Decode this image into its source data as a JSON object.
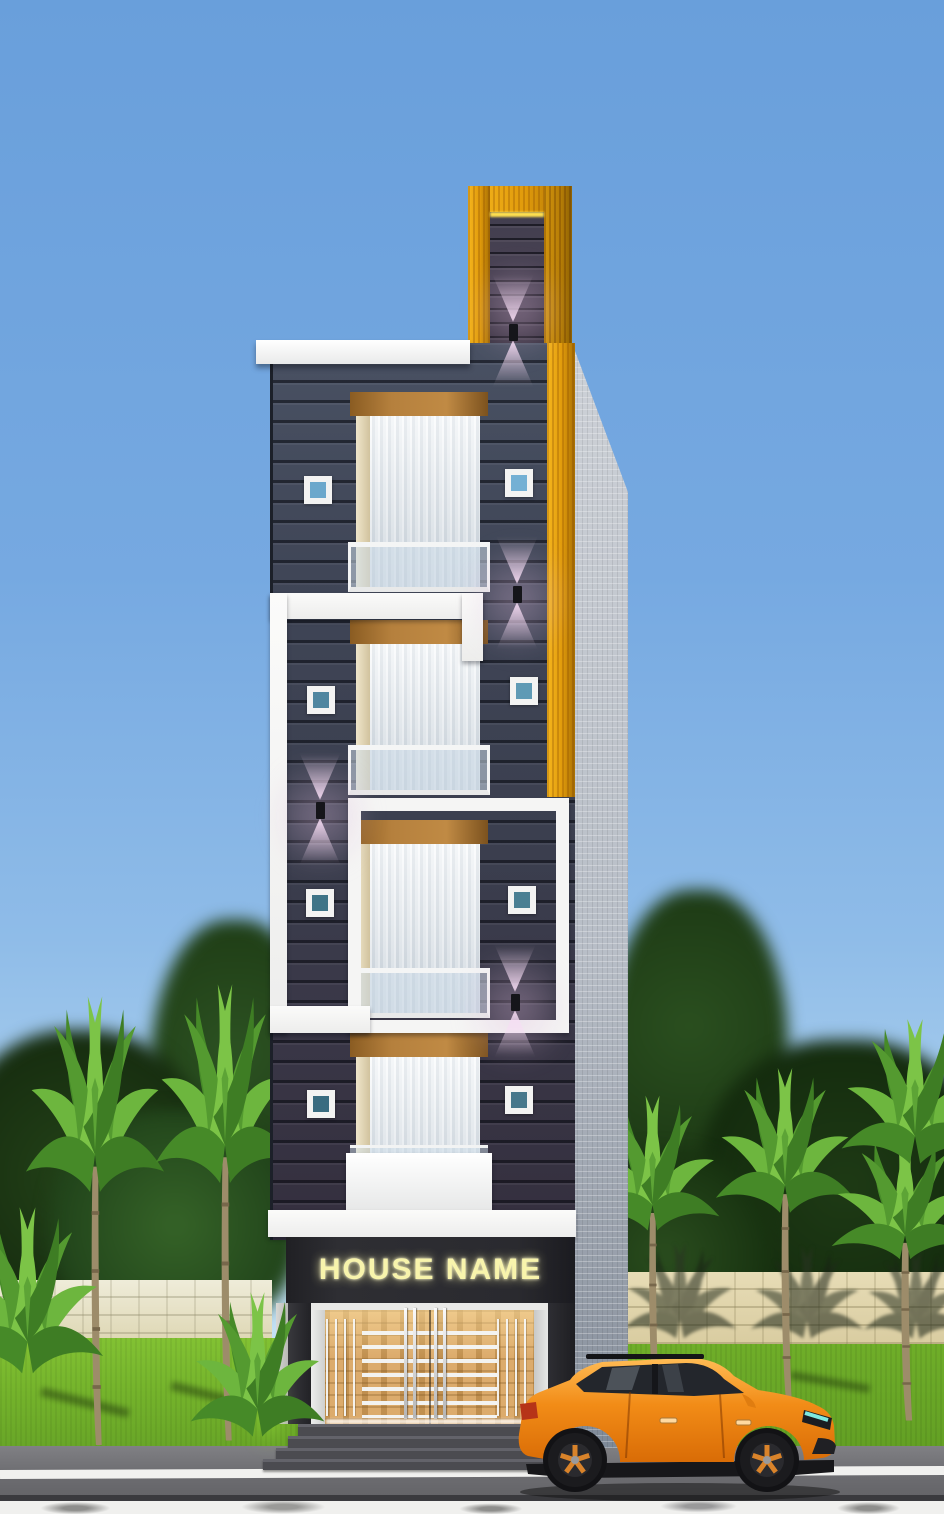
{
  "scene": {
    "kind": "3D architectural render, dusk lighting",
    "subject": "narrow four-storey modern house front elevation with shop-style entrance",
    "sign": {
      "text": "HOUSE NAME"
    },
    "counts": {
      "floors": 4,
      "balcony_windows": 4,
      "small_square_windows": 8,
      "wall_lights": 4,
      "tower_lights": 1,
      "entrance_steps": 4,
      "palm_trees": 7
    },
    "palette": {
      "sky_top": "#699fdb",
      "sky_horizon": "#d3ecf8",
      "facade_dark": "#3c4252",
      "facade_groove": "#12141d",
      "gold_accent": "#e8a414",
      "gold_glow_line": "#ffe14f",
      "white_trim": "#f4f4f3",
      "side_wall_gray": "#b8bec7",
      "window_wood": "#b5803d",
      "curtain_white": "#e8edf1",
      "balcony_glass": "#cedde9",
      "square_window_glass": "#4f86a0",
      "wall_light_glow": "#f7ddf5",
      "sign_panel": "#26262b",
      "sign_letters": "#f8f4ac",
      "entrance_wood": "#c99a5a",
      "entrance_bars": "#f3f3f1",
      "steps_gray": "#4b4b50",
      "lawn_green": "#74b32b",
      "road_gray": "#6d6d71",
      "road_line_white": "#f1f1ef",
      "boundary_wall_cream": "#e4dab6",
      "foliage_dark": "#23411a",
      "palm_leaf_green": "#6db63e",
      "car_body_orange": "#f08a1c",
      "car_glass_dark": "#23262c",
      "car_headlight_cyan": "#7fe8df"
    },
    "car": {
      "type": "SUV, side view, facing right",
      "body_color": "#f08a1c"
    }
  }
}
